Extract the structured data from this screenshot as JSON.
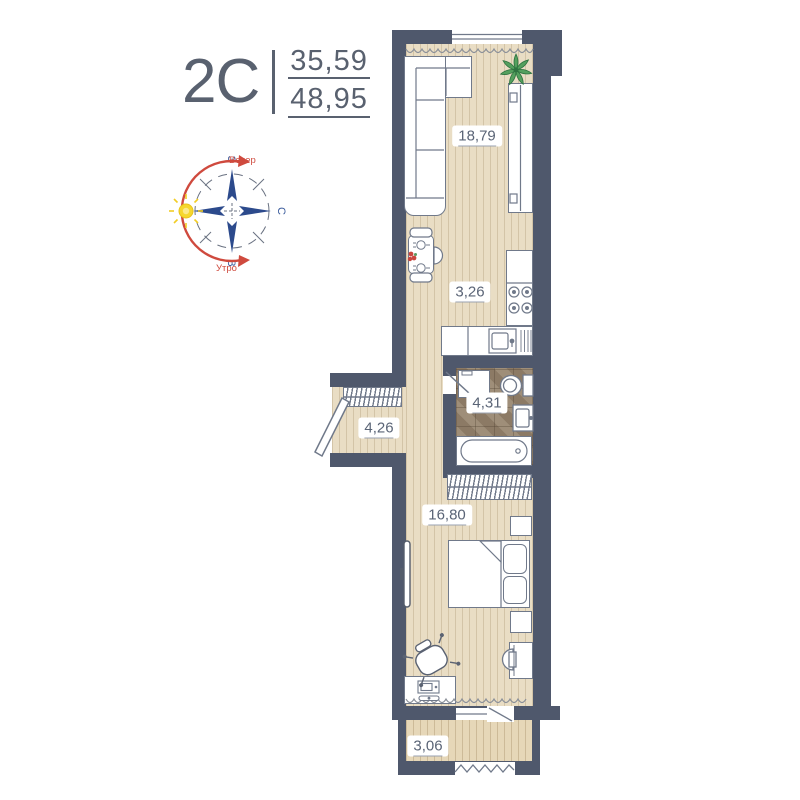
{
  "plan": {
    "type_label": "2C",
    "area_top": "35,59",
    "area_bottom": "48,95"
  },
  "compass": {
    "evening_label": "Вечер",
    "morning_label": "Утро",
    "dir_top": "З",
    "dir_right": "С",
    "dir_bottom": "В"
  },
  "rooms": {
    "living": {
      "label": "18,79"
    },
    "kitchen": {
      "label": "3,26"
    },
    "bathroom": {
      "label": "4,31"
    },
    "hallway": {
      "label": "4,26"
    },
    "bedroom": {
      "label": "16,80"
    },
    "balcony": {
      "label": "3,06"
    }
  },
  "colors": {
    "wall": "#4f586c",
    "floor_wood": "#e9ddc4",
    "bathroom_tile": "#97856e",
    "accent_red": "#cf4a3e",
    "accent_blue": "#2c4a8c",
    "sun_yellow": "#f6d72e",
    "plant_green": "#4e9b57",
    "text": "#59616f"
  }
}
